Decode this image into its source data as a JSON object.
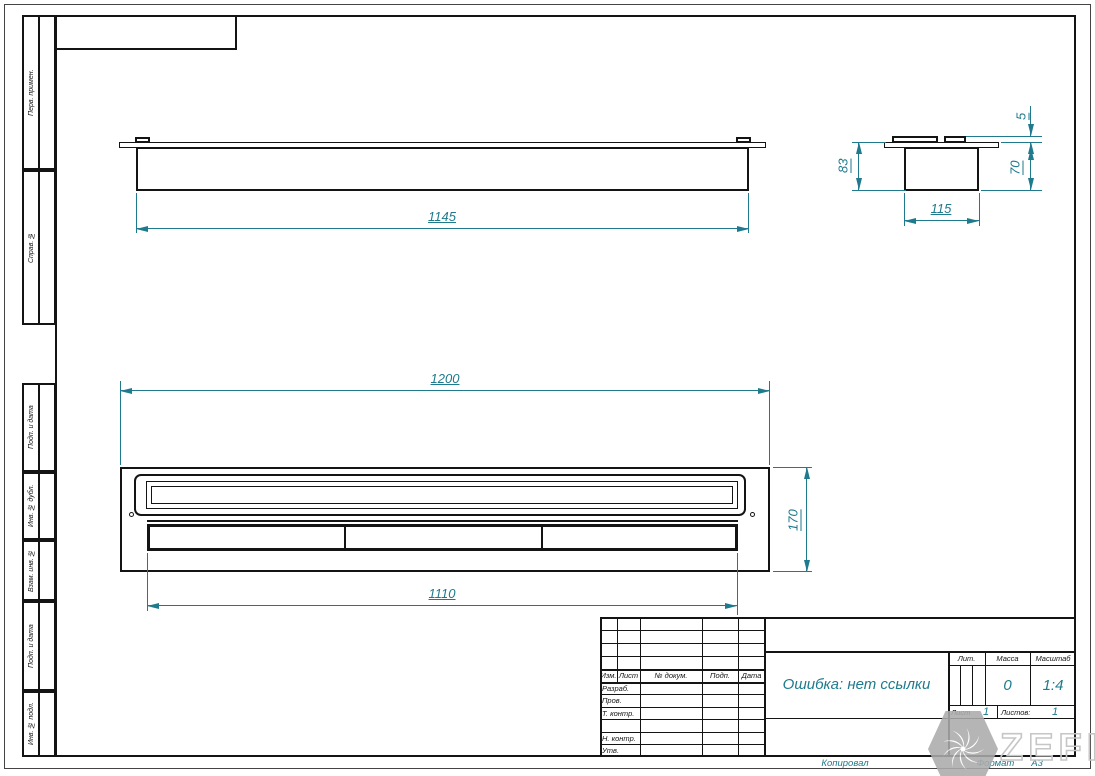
{
  "frame": {
    "margin_labels": [
      "Перв. примен.",
      "Справ. №",
      "Подп. и дата",
      "Инв. № дубл.",
      "Взам. инв. №",
      "Подп. и дата",
      "Инв. № подл."
    ],
    "footer": {
      "copied": "Копировал",
      "format_label": "Формат",
      "format_value": "А3"
    }
  },
  "views": {
    "front": {
      "width_dim": "1145"
    },
    "side": {
      "height_total": "83",
      "top_gap": "5",
      "body_height": "70",
      "width_dim": "115"
    },
    "plan": {
      "width_dim": "1200",
      "height_dim": "170",
      "tray_width_dim": "1110"
    }
  },
  "title_block": {
    "change_header": [
      "Изм.",
      "Лист",
      "№ докум.",
      "Подп.",
      "Дата"
    ],
    "role_rows": [
      "Разраб.",
      "Пров.",
      "Т. контр.",
      "",
      "Н. контр.",
      "Утв."
    ],
    "designation": "Ошибка: нет ссылки",
    "lit_label": "Лит.",
    "mass_label": "Масса",
    "mass_value": "0",
    "scale_label": "Масштаб",
    "scale_value": "1:4",
    "sheet_label": "Лист",
    "sheet_value": "1",
    "sheets_label": "Листов:",
    "sheets_value": "1"
  },
  "watermark": {
    "brand": "ZEFIRE"
  },
  "colors": {
    "dimension": "#1e7a8c",
    "line": "#141414",
    "watermark_gray": "#ababab"
  }
}
